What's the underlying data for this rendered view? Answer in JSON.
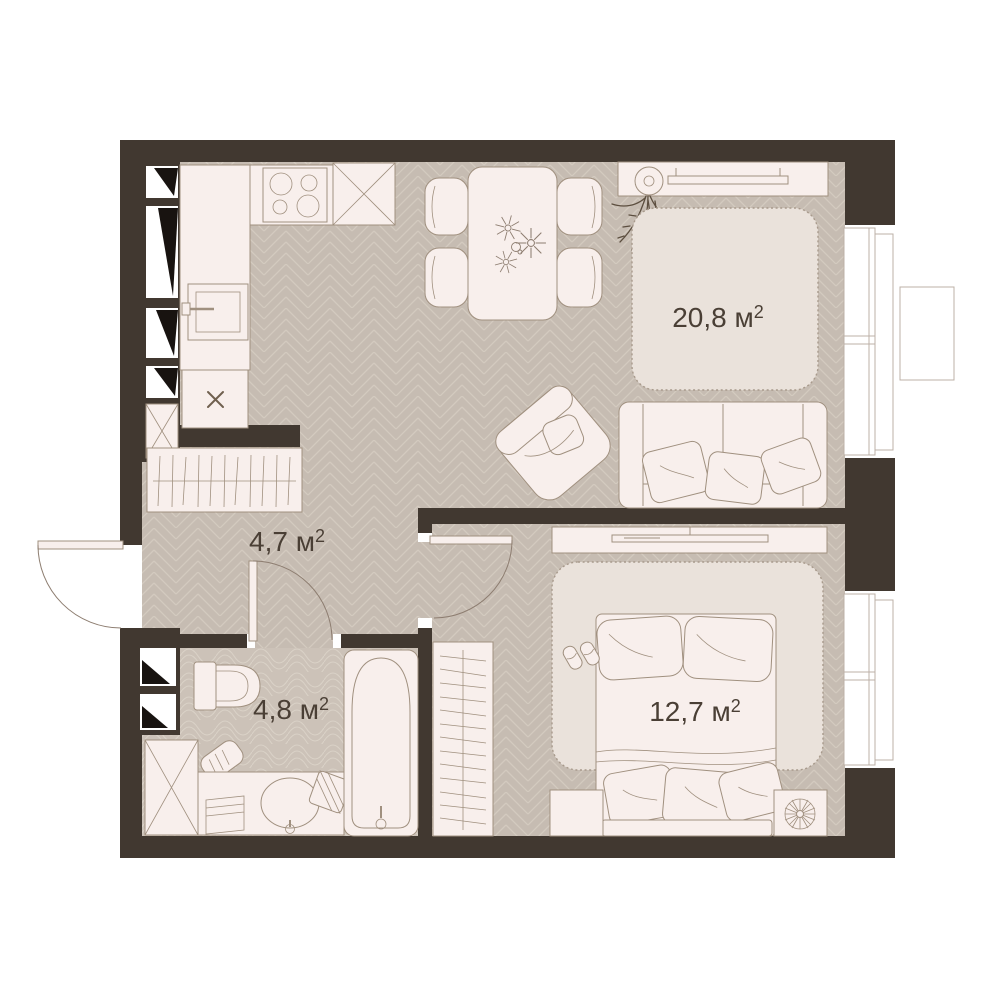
{
  "plan_title": "one-bedroom apartment floor plan",
  "rooms": {
    "living_kitchen": {
      "label": "20,8 м²",
      "area_text": "20,8 м",
      "sup": "2"
    },
    "hallway": {
      "label": "4,7 м²",
      "area_text": "4,7 м",
      "sup": "2"
    },
    "bathroom": {
      "label": "4,8 м²",
      "area_text": "4,8 м",
      "sup": "2"
    },
    "bedroom": {
      "label": "12,7 м²",
      "area_text": "12,7 м",
      "sup": "2"
    }
  },
  "colors": {
    "wall": "#413830",
    "floor": "#c6bcb2",
    "floor_line": "#d3cabf",
    "bath_floor": "#ccc2b8",
    "bath_line": "#dad2c7",
    "furniture": "#f8efec",
    "furniture_stroke": "#a0907f",
    "rug": "#eae2db",
    "rug_stroke": "#a89a8c",
    "window_stroke": "#bcb1a7",
    "text": "#4a3f35",
    "plant": "#5c4e3f",
    "wedge": "#181310",
    "white": "#ffffff"
  }
}
